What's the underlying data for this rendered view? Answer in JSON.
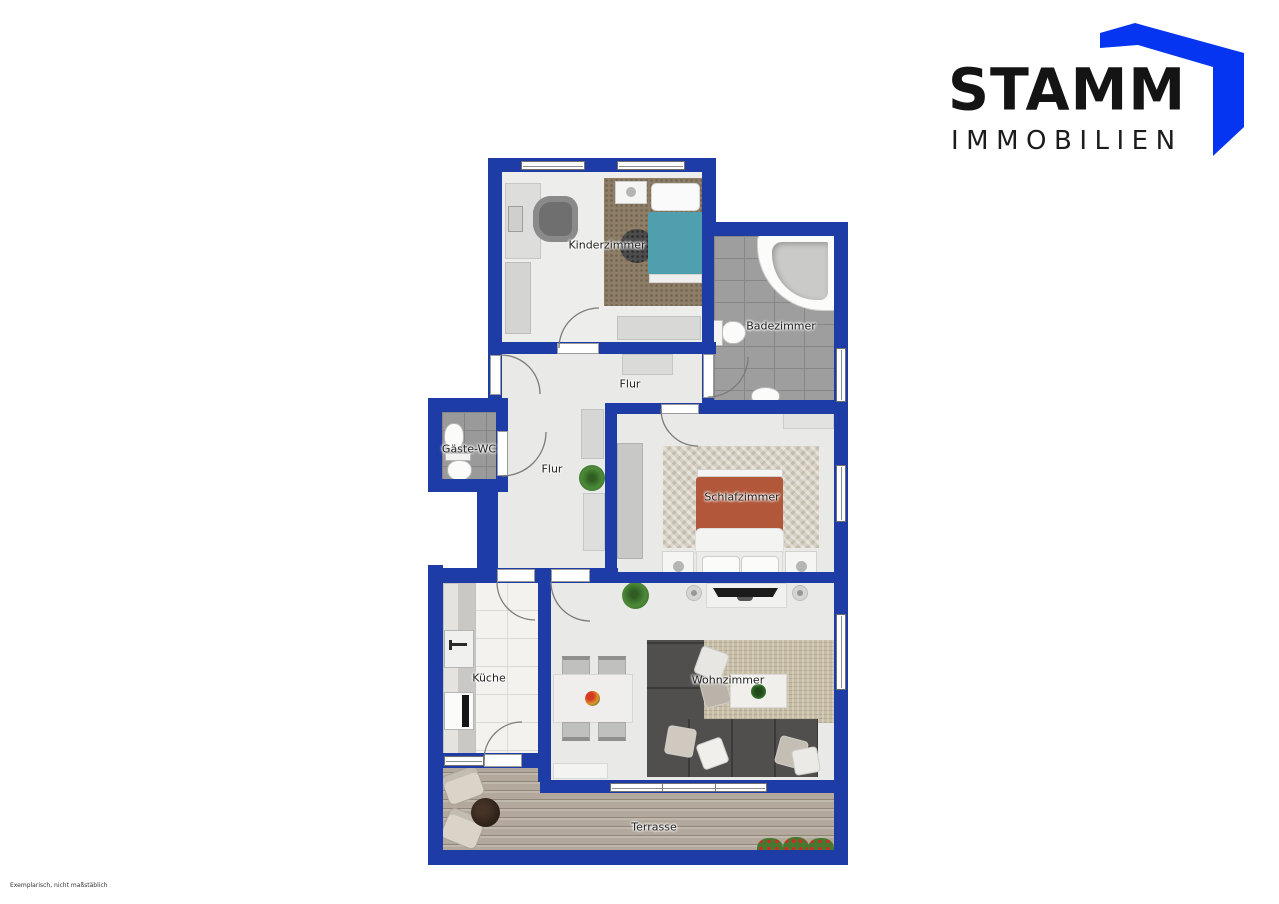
{
  "logo": {
    "brand": "STAMM",
    "subtitle": "IMMOBILIEN",
    "accent_color": "#0535f0",
    "text_color": "#141414"
  },
  "floorplan": {
    "wall_color": "#1e3ca6",
    "rooms": {
      "kinderzimmer": "Kinderzimmer",
      "badezimmer": "Badezimmer",
      "flur_oben": "Flur",
      "gaeste_wc": "Gäste-WC",
      "flur": "Flur",
      "schlafzimmer": "Schlafzimmer",
      "kueche": "Küche",
      "wohnzimmer": "Wohnzimmer",
      "terrasse": "Terrasse"
    }
  },
  "footnote": "Exemplarisch, nicht maßstäblich"
}
